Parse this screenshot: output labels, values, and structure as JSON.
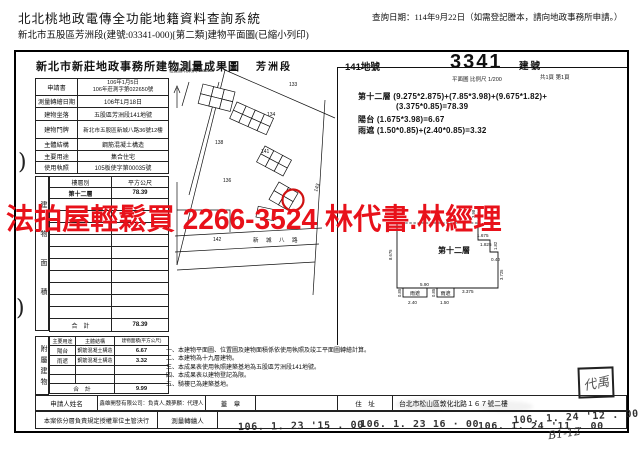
{
  "page_header": {
    "system_title": "北北桃地政電傳全功能地籍資料查詢系統",
    "subtitle": "新北市五股區芳洲段(建號:03341-000)[第二類]建物平面圖(已縮小列印)",
    "query_date": "查詢日期：114年9月22日（如需登記謄本，請向地政事務所申請。）"
  },
  "doc": {
    "office_title": "新北市新莊地政事務所建物測量成果圖",
    "section_name": "芳洲段",
    "land_no": "141地號",
    "building_no": "3341",
    "building_no_label": "建號",
    "plan_scale": "平面圖 比例尺 1/200",
    "page_note": "共1頁 第1頁",
    "map_scale": "位置圖 比例尺 1/3000"
  },
  "info_table": {
    "rows": [
      {
        "label": "申請書",
        "value": "106年1月5日\n106年莊測字第022650號"
      },
      {
        "label": "測量轉繪日期",
        "value": "106年1月18日"
      },
      {
        "label": "建物坐落",
        "value": "五股區芳洲段141地號"
      },
      {
        "label": "建物門牌",
        "value": "新北市五股區新城八路36號12樓"
      },
      {
        "label": "主體結構",
        "value": "鋼筋混凝土構造"
      },
      {
        "label": "主要用途",
        "value": "集合住宅"
      },
      {
        "label": "使用執照",
        "value": "105板使字第00035號"
      }
    ]
  },
  "floor_table": {
    "vertical_label": "建物面積",
    "col_floor": "樓層別",
    "col_area": "平方公尺",
    "rows": [
      {
        "floor": "第十二層",
        "area": "78.39"
      }
    ],
    "total_label": "合　計",
    "total_value": "78.39"
  },
  "annex_table": {
    "vertical_label": "附屬建物",
    "col_use": "主要用途",
    "col_structure": "主體結構",
    "col_area": "建物面積(平方公尺)",
    "rows": [
      {
        "use": "陽台",
        "structure": "鋼筋混凝土構造",
        "area": "6.67"
      },
      {
        "use": "雨遮",
        "structure": "鋼筋混凝土構造",
        "area": "3.32"
      }
    ],
    "total_label": "合　計",
    "total_value": "9.99"
  },
  "bottom": {
    "applicant_label": "申請人姓名",
    "applicant_value": "鑫雄開發有限公司：負責人,魏夢麟：代理人",
    "seal_label": "蓋　章",
    "address_label": "住　址",
    "address_value": "台北市松山區敦化北路１６７號二樓",
    "approval_label": "本案依分層負責規定授權單位主管決行",
    "surveyor_label": "測量轉繪人"
  },
  "formula": {
    "line1": "第十二層 (9.275*2.875)+(7.85*3.98)+(9.675*1.82)+",
    "line2": "(3.375*0.85)=78.39",
    "line3": "陽台 (1.675*3.98)=6.67",
    "line4": "雨遮 (1.50*0.85)+(2.40*0.85)=3.32"
  },
  "notes": {
    "line1": "一、本建物平面圖、位置圖及建物面積係依使用執照及竣工平面圖轉繪計算。",
    "line2": "二、本建物為十九層建物。",
    "line3": "三、本成果表使用執照建築基地為五股區芳洲段141地號。",
    "line4": "四、本成果表以建物登記為限。",
    "line5": "五、騎樓已為建築基地。"
  },
  "map": {
    "parcels": [
      "133",
      "134",
      "138",
      "141",
      "136",
      "143",
      "142"
    ],
    "road": "新 城 八 路"
  },
  "plan": {
    "floor_label": "第十二層",
    "canopy1": "雨遮",
    "canopy2": "雨遮",
    "dims": {
      "left": "8.675",
      "top": "3.98",
      "a": "1.675",
      "b": "1.825",
      "c": "1.82",
      "d": "0.40",
      "e": "3.725",
      "f": "5.90",
      "g": "3.375",
      "h": "2.40",
      "i": "1.50",
      "j": "0.85",
      "k": "0.85"
    }
  },
  "watermark": "法拍屋輕鬆買  2266-3524  林代書.林經理",
  "stamps": {
    "s1": "106. 1. 23 '15 . 00",
    "s2": "106. 1. 23  16 · 00",
    "s3": "106. 1. 24 '11 . 00",
    "s4": "106. 1. 24 '12 . 00",
    "handwritten_note": "B1-12",
    "corner_seal": "代禹"
  },
  "marks": {
    "bracket1": ")",
    "bracket2": ")"
  }
}
